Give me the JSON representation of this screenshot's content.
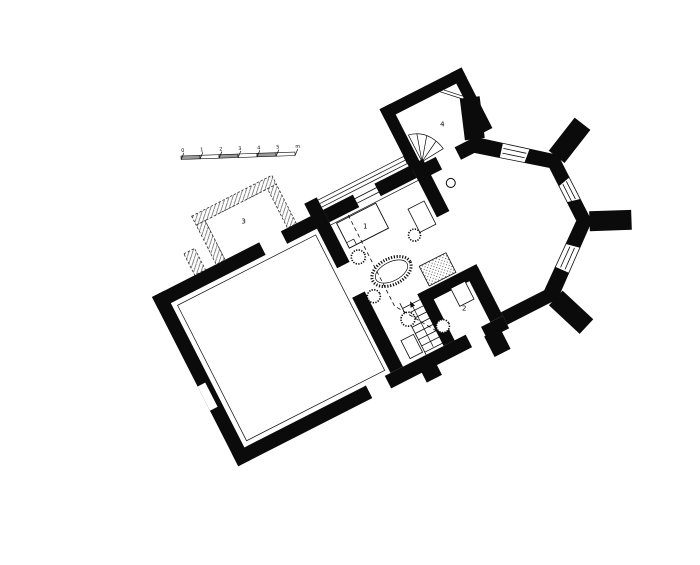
{
  "figure": {
    "kind": "architectural-floor-plan",
    "orientation_deg": -27
  },
  "palette": {
    "ink": "#0b0b0b",
    "paper": "#ffffff",
    "stipple": "#333333",
    "ruin_hatch": "#555555",
    "scale_shade": "#999999"
  },
  "plan": {
    "rooms": [
      {
        "number": "1",
        "name": "main-room"
      },
      {
        "number": "2",
        "name": "stair-room"
      },
      {
        "number": "3",
        "name": "ruined-annex"
      },
      {
        "number": "4",
        "name": "sacristy"
      }
    ]
  },
  "scale_bar": {
    "tick_labels": [
      "0",
      "1",
      "2",
      "3",
      "4",
      "5",
      "m"
    ]
  }
}
